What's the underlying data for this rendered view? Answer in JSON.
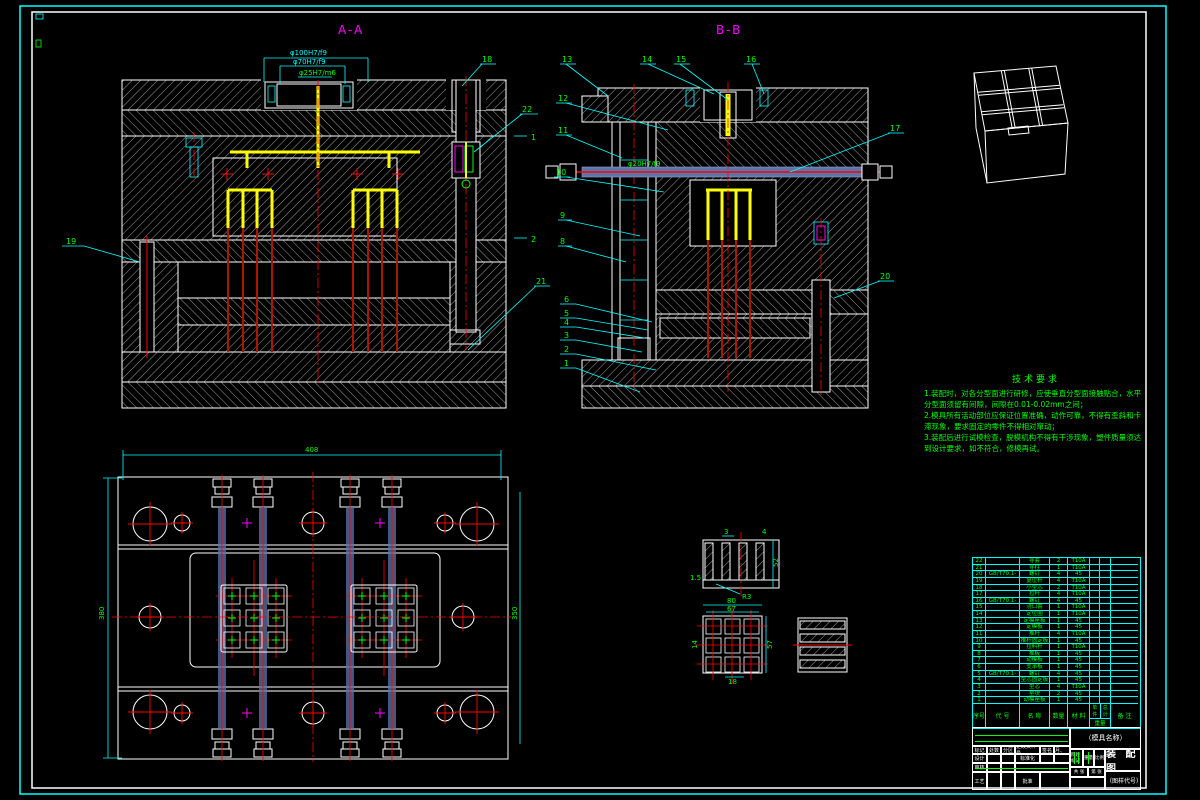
{
  "drawing": {
    "section_aa": {
      "title": "A-A",
      "dim1": "φ100H7/f9",
      "dim2": "φ70H7/f9",
      "dim3": "φ25H7/m6",
      "callouts": {
        "c19": "19",
        "c18": "18",
        "c22": "22",
        "c21": "21",
        "m1": "1",
        "m2": "2"
      }
    },
    "section_bb": {
      "title": "B-B",
      "dim_rod": "φ20H7/f9",
      "callouts": {
        "c13": "13",
        "c14": "14",
        "c15": "15",
        "c16": "16",
        "c12": "12",
        "c11": "11",
        "c10": "10",
        "c9": "9",
        "c8": "8",
        "c6": "6",
        "c5": "5",
        "c4": "4",
        "c3": "3",
        "c2": "2",
        "c1": "1",
        "c17": "17",
        "c20": "20"
      }
    },
    "plan": {
      "dim_width": "408",
      "dim_left": "380",
      "dim_right": "350"
    },
    "details": {
      "d1": {
        "t3": "3",
        "t4": "4",
        "t52": "52",
        "t15": "1.5",
        "tr3": "R3"
      },
      "d2": {
        "t80": "80",
        "t67": "67",
        "t57": "57",
        "t14": "14",
        "t18": "18"
      }
    }
  },
  "tech_req": {
    "title": "技术要求",
    "lines": [
      "1.装配时，对各分型面进行研修，应使垂直分型面接触贴合，水平",
      "分型面须留有间隙，间隙在0.01-0.02mm之间；",
      "2.模具所有活动部位应保证位置准确，动作可靠，不得有歪斜和卡",
      "滞现象，要求固定的零件不得相对窜动；",
      "3.装配后进行试模检查，脱模机构不得有干涉现象，塑件质量须达",
      "到设计要求，如不符合，修模再试。"
    ]
  },
  "bom": {
    "headers": {
      "no": "序号",
      "code": "代 号",
      "name": "名 称",
      "qty": "数量",
      "mat": "材 料",
      "unit": "单件",
      "total": "总计",
      "weight": "重量",
      "note": "备 注"
    },
    "rows": [
      {
        "no": "22",
        "code": "",
        "name": "导套",
        "qty": "2",
        "mat": "T10A"
      },
      {
        "no": "21",
        "code": "",
        "name": "导柱",
        "qty": "1",
        "mat": "T10A"
      },
      {
        "no": "20",
        "code": "GB/T70.1-2000",
        "name": "螺钉",
        "qty": "4",
        "mat": "45"
      },
      {
        "no": "19",
        "code": "",
        "name": "复位杆",
        "qty": "4",
        "mat": "T10A"
      },
      {
        "no": "18",
        "code": "",
        "name": "小型芯",
        "qty": "2",
        "mat": "T10A"
      },
      {
        "no": "17",
        "code": "",
        "name": "拉杆",
        "qty": "4",
        "mat": "T10A"
      },
      {
        "no": "16",
        "code": "GB/T70.1-2000",
        "name": "螺钉",
        "qty": "4",
        "mat": "45"
      },
      {
        "no": "15",
        "code": "",
        "name": "浇口套",
        "qty": "1",
        "mat": "T10A"
      },
      {
        "no": "14",
        "code": "",
        "name": "定位圈",
        "qty": "1",
        "mat": "T10A"
      },
      {
        "no": "13",
        "code": "",
        "name": "定模座板",
        "qty": "1",
        "mat": "45"
      },
      {
        "no": "12",
        "code": "",
        "name": "定模板",
        "qty": "1",
        "mat": "45"
      },
      {
        "no": "11",
        "code": "",
        "name": "推杆",
        "qty": "4",
        "mat": "T10A"
      },
      {
        "no": "10",
        "code": "",
        "name": "推杆固定板",
        "qty": "1",
        "mat": "45"
      },
      {
        "no": "9",
        "code": "",
        "name": "拉料杆",
        "qty": "1",
        "mat": "T10A"
      },
      {
        "no": "8",
        "code": "",
        "name": "推板",
        "qty": "1",
        "mat": "45"
      },
      {
        "no": "7",
        "code": "",
        "name": "动模板",
        "qty": "1",
        "mat": "45"
      },
      {
        "no": "6",
        "code": "",
        "name": "支承板",
        "qty": "1",
        "mat": "45"
      },
      {
        "no": "5",
        "code": "GB/T70.1-2000",
        "name": "螺钉",
        "qty": "4",
        "mat": "45"
      },
      {
        "no": "4",
        "code": "",
        "name": "型芯固定板",
        "qty": "1",
        "mat": "45"
      },
      {
        "no": "3",
        "code": "",
        "name": "型芯",
        "qty": "4",
        "mat": "T10A"
      },
      {
        "no": "2",
        "code": "",
        "name": "垫块",
        "qty": "2",
        "mat": "45"
      },
      {
        "no": "1",
        "code": "",
        "name": "动模座板",
        "qty": "1",
        "mat": "45"
      }
    ]
  },
  "title_block": {
    "part_name": "（模具名称）",
    "drawing_name": "装 配 图",
    "drawing_code": "（图样代号）",
    "mark": "标记",
    "count": "处数",
    "zone": "分区",
    "change_doc": "更改文件号",
    "sign": "签名",
    "date": "年、月、日",
    "design": "设计",
    "standardize": "标准化",
    "review": "审核",
    "process": "工艺",
    "approve": "批准",
    "stage": "阶段标记",
    "weight": "重量",
    "scale": "比例",
    "total_sheets": "共 张",
    "sheet_no": "第 张"
  },
  "colors": {
    "line": "#ffffff",
    "dim": "#00ffff",
    "text": "#00ff00",
    "runner": "#ffff00",
    "center": "#ff0000",
    "view_title": "#ff00ff"
  }
}
